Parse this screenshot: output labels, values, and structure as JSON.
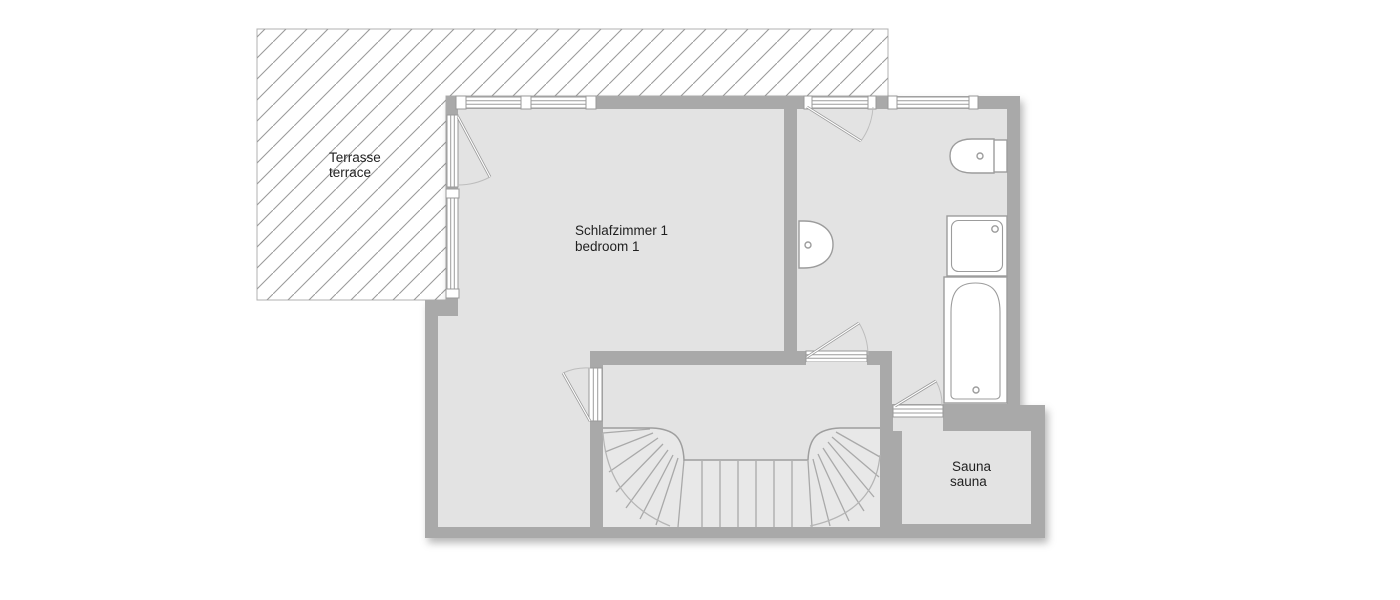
{
  "floorplan": {
    "rooms": {
      "terrace": {
        "label_de": "Terrasse",
        "label_en": "terrace"
      },
      "bedroom": {
        "label_de": "Schlafzimmer 1",
        "label_en": "bedroom 1"
      },
      "sauna": {
        "label_de": "Sauna",
        "label_en": "sauna"
      }
    },
    "fixtures": {
      "toilet": "toilet",
      "sink": "sink",
      "shower": "shower",
      "bathtub": "bathtub",
      "staircase": "curved-staircase"
    },
    "colors": {
      "wall": "#a9a9a9",
      "floor": "#e3e3e3",
      "stair_fill": "#e8e8e8",
      "fixture_fill": "#ffffff",
      "fixture_stroke": "#9c9c9c",
      "hatch_line": "#9b9b9b",
      "terrace_outline": "#b0b0b0",
      "text": "#1f1f1f",
      "background": "#ffffff"
    }
  }
}
